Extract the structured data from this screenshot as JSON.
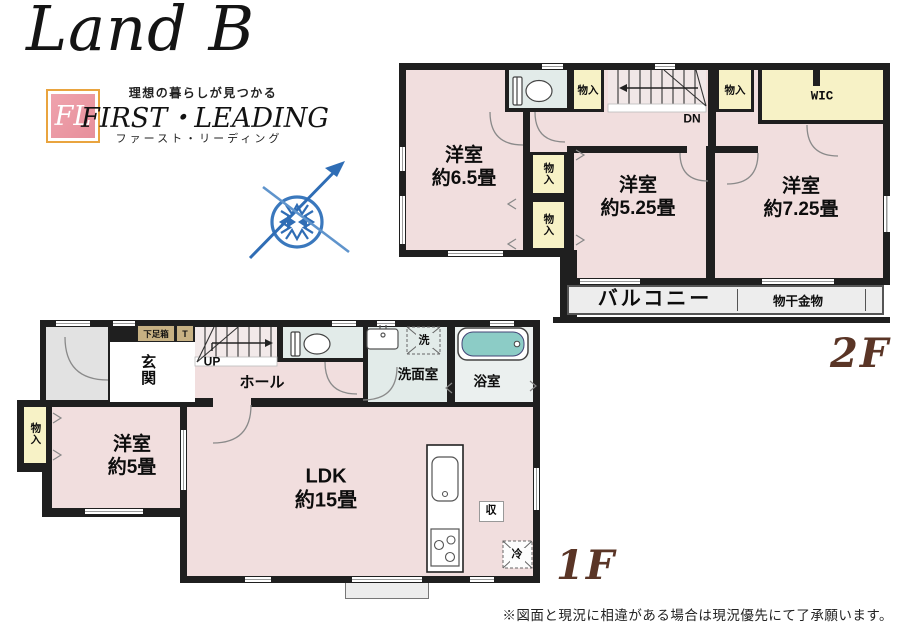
{
  "branding": {
    "logo_script": "Land B",
    "fl_monogram": "FL",
    "tagline": "理想の暮らしが見つかる",
    "company_en": "FIRST・LEADING",
    "company_kana": "ファースト・リーディング"
  },
  "floor2": {
    "floor_label": "2F",
    "room_65": "洋室\n約6.5畳",
    "room_525": "洋室\n約5.25畳",
    "room_725": "洋室\n約7.25畳",
    "wic": "WIC",
    "closet": "物入",
    "stairs_dn": "DN",
    "balcony": "バルコニー",
    "drying_hardware": "物干金物"
  },
  "floor1": {
    "floor_label": "1F",
    "entrance": "玄関",
    "shoe_box": "下足箱",
    "shoe_box_t": "T",
    "stairs_up": "UP",
    "hall": "ホール",
    "washroom": "洗面室",
    "bathroom": "浴室",
    "washer": "洗",
    "closet": "物入",
    "room_5": "洋室\n約5畳",
    "ldk": "LDK\n約15畳",
    "storage": "収",
    "fridge": "冷"
  },
  "footer": {
    "disclaimer": "※図面と現況に相違がある場合は現況優先にて了承願います。"
  },
  "colors": {
    "wall": "#1f1f1f",
    "room_pink": "#f1dede",
    "closet_yellow": "#f7f2c6",
    "sanitary_mint": "#e2ebe9",
    "bathtub_teal": "#8cccc6",
    "balcony_gray": "#ededed",
    "porch_gray": "#e2e2e2",
    "wood_tan": "#c7b183",
    "floor_label_brown": "#5a3526",
    "logo_gold": "#e9a43f",
    "logo_pink": "#e78f9b",
    "compass_blue": "#2f6db5"
  }
}
